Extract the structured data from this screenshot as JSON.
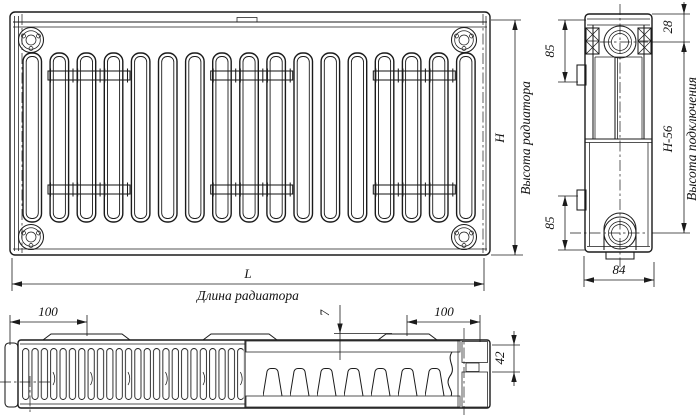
{
  "drawing": {
    "type": "radiator-technical-drawing",
    "background": "#ffffff",
    "line_color": "#1b1b1b",
    "front_view": {
      "height_symbol": "H",
      "height_caption": "Высота радиатора",
      "length_symbol": "L",
      "length_caption": "Длина радиатора"
    },
    "side_view": {
      "top_inlet_offset": "28",
      "upper_bracket_offset": "85",
      "lower_bracket_offset": "85",
      "connection_height_symbol": "H-56",
      "connection_height_caption": "Высота подключения",
      "depth": "84"
    },
    "top_view": {
      "left_bracket_offset": "100",
      "right_bracket_offset": "100",
      "bracket_plate_gap": "7",
      "panel_depth": "42"
    }
  }
}
